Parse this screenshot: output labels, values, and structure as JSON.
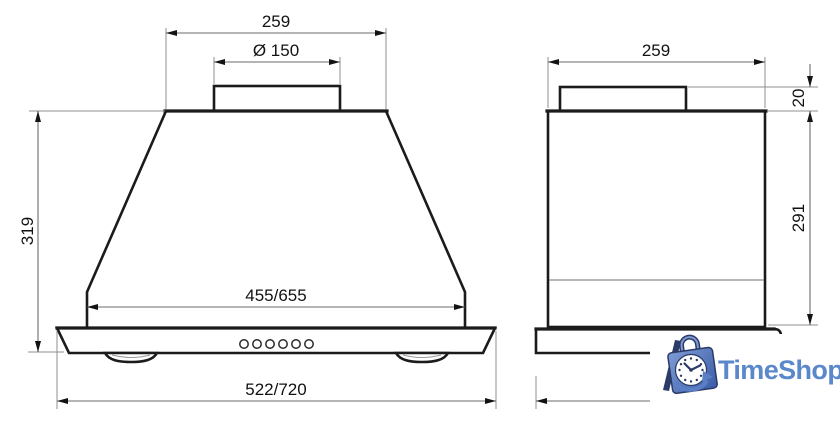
{
  "drawing": {
    "outline_color": "#1b1b1b",
    "dimension_line_color": "#6b6b6b",
    "dimension_text_color": "#121212"
  },
  "front_view": {
    "dim_duct_top_width": "259",
    "dim_duct_diameter": "Ø 150",
    "dim_height": "319",
    "dim_bottom_body_width": "455/655",
    "dim_overall_width": "522/720",
    "control_buttons_count": 6
  },
  "side_view": {
    "dim_body_depth": "259",
    "dim_duct_collar_height": "20",
    "dim_body_height": "291"
  },
  "watermark": {
    "brand": "TimeShop",
    "text_color": "#5b87cb",
    "bag_color_light": "#7e9bd4",
    "bag_color_dark": "#3a5ca8",
    "bag_outline_color": "#2b3a66",
    "swoosh_color": "#5b7fc4"
  }
}
